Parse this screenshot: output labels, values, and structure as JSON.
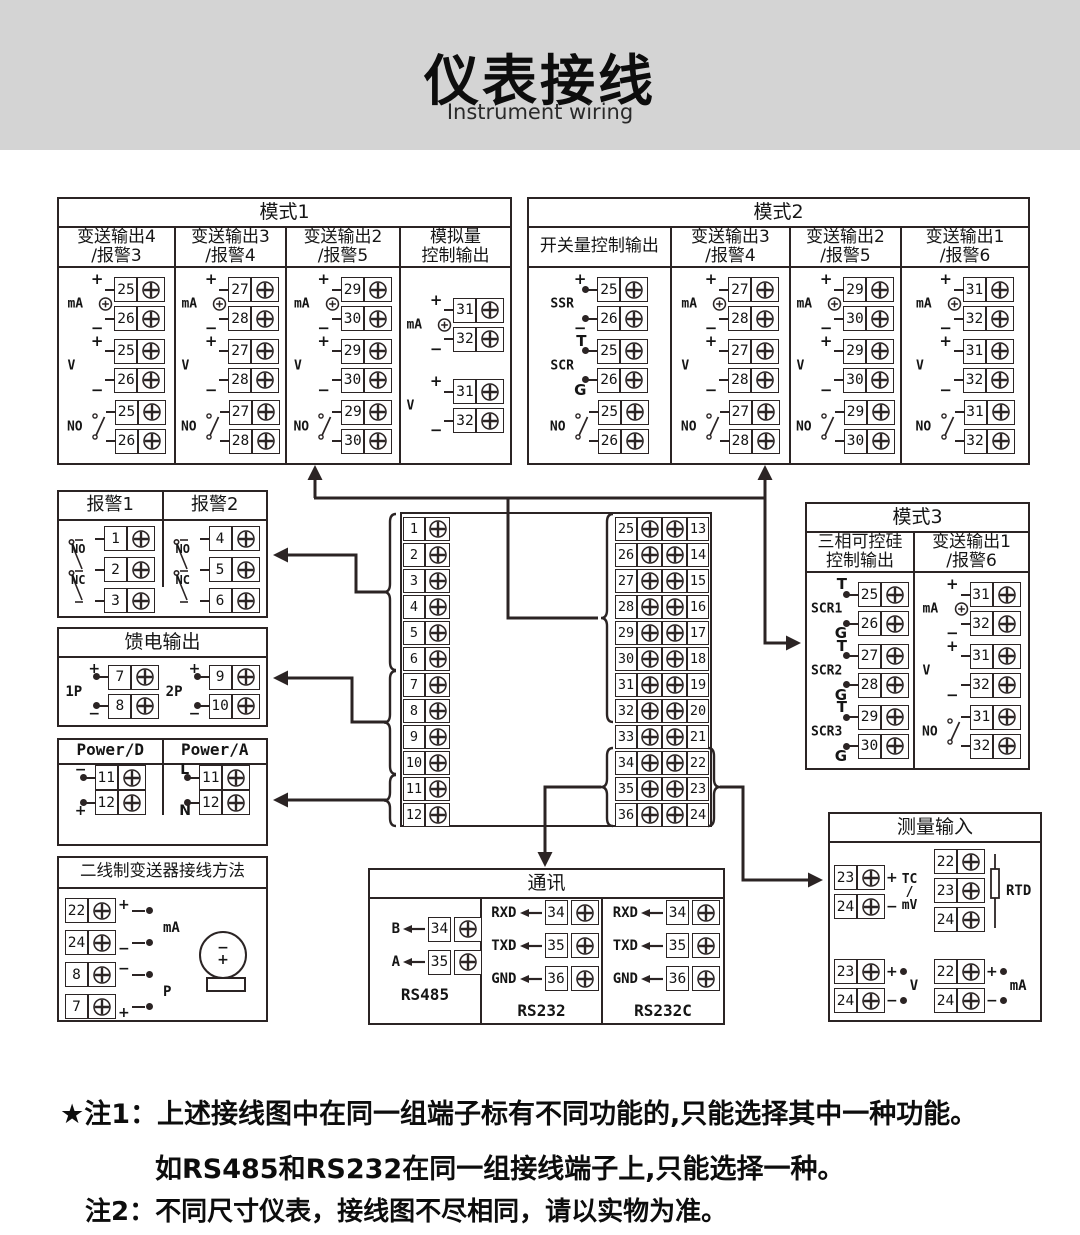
{
  "page": {
    "title": "仪表接线",
    "subtitle": "Instrument wiring"
  },
  "colors": {
    "line": "#2b2424",
    "band": "#d4d4d4",
    "paper": "#ffffff"
  },
  "notes": [
    {
      "prefix": "★注1：",
      "text": "上述接线图中在同一组端子标有不同功能的,只能选择其中一种功能。"
    },
    {
      "prefix": "",
      "text": "如RS485和RS232在同一组接线端子上,只能选择一种。"
    },
    {
      "prefix": "注2：",
      "text": "不同尺寸仪表，接线图不尽相同，请以实物为准。"
    }
  ],
  "mode1": {
    "title": "模式1",
    "columns": [
      {
        "label": "变送输出4\n/报警3",
        "groups": [
          {
            "kind": "source",
            "label": "mA",
            "signs": [
              "+",
              "−"
            ],
            "terminals": [
              "25",
              "26"
            ]
          },
          {
            "kind": "volt",
            "label": "V",
            "signs": [
              "+",
              "−"
            ],
            "terminals": [
              "25",
              "26"
            ]
          },
          {
            "kind": "relay",
            "label": "NO",
            "terminals": [
              "25",
              "26"
            ]
          }
        ]
      },
      {
        "label": "变送输出3\n/报警4",
        "groups": [
          {
            "kind": "source",
            "label": "mA",
            "signs": [
              "+",
              "−"
            ],
            "terminals": [
              "27",
              "28"
            ]
          },
          {
            "kind": "volt",
            "label": "V",
            "signs": [
              "+",
              "−"
            ],
            "terminals": [
              "27",
              "28"
            ]
          },
          {
            "kind": "relay",
            "label": "NO",
            "terminals": [
              "27",
              "28"
            ]
          }
        ]
      },
      {
        "label": "变送输出2\n/报警5",
        "groups": [
          {
            "kind": "source",
            "label": "mA",
            "signs": [
              "+",
              "−"
            ],
            "terminals": [
              "29",
              "30"
            ]
          },
          {
            "kind": "volt",
            "label": "V",
            "signs": [
              "+",
              "−"
            ],
            "terminals": [
              "29",
              "30"
            ]
          },
          {
            "kind": "relay",
            "label": "NO",
            "terminals": [
              "29",
              "30"
            ]
          }
        ]
      },
      {
        "label": "模拟量\n控制输出",
        "groups": [
          {
            "kind": "source",
            "label": "mA",
            "signs": [
              "+",
              "−"
            ],
            "terminals": [
              "31",
              "32"
            ]
          },
          {
            "kind": "volt",
            "label": "V",
            "signs": [
              "+",
              "−"
            ],
            "terminals": [
              "31",
              "32"
            ]
          }
        ]
      }
    ]
  },
  "mode2": {
    "title": "模式2",
    "columns": [
      {
        "label": "开关量控制输出",
        "groups": [
          {
            "kind": "ssr",
            "label": "SSR",
            "signs": [
              "+",
              "−"
            ],
            "terminals": [
              "25",
              "26"
            ]
          },
          {
            "kind": "scr",
            "label": "SCR",
            "signs": [
              "T",
              "G"
            ],
            "terminals": [
              "25",
              "26"
            ]
          },
          {
            "kind": "relay",
            "label": "NO",
            "terminals": [
              "25",
              "26"
            ]
          }
        ]
      },
      {
        "label": "变送输出3\n/报警4",
        "groups": [
          {
            "kind": "source",
            "label": "mA",
            "signs": [
              "+",
              "−"
            ],
            "terminals": [
              "27",
              "28"
            ]
          },
          {
            "kind": "volt",
            "label": "V",
            "signs": [
              "+",
              "−"
            ],
            "terminals": [
              "27",
              "28"
            ]
          },
          {
            "kind": "relay",
            "label": "NO",
            "terminals": [
              "27",
              "28"
            ]
          }
        ]
      },
      {
        "label": "变送输出2\n/报警5",
        "groups": [
          {
            "kind": "source",
            "label": "mA",
            "signs": [
              "+",
              "−"
            ],
            "terminals": [
              "29",
              "30"
            ]
          },
          {
            "kind": "volt",
            "label": "V",
            "signs": [
              "+",
              "−"
            ],
            "terminals": [
              "29",
              "30"
            ]
          },
          {
            "kind": "relay",
            "label": "NO",
            "terminals": [
              "29",
              "30"
            ]
          }
        ]
      },
      {
        "label": "变送输出1\n/报警6",
        "groups": [
          {
            "kind": "source",
            "label": "mA",
            "signs": [
              "+",
              "−"
            ],
            "terminals": [
              "31",
              "32"
            ]
          },
          {
            "kind": "volt",
            "label": "V",
            "signs": [
              "+",
              "−"
            ],
            "terminals": [
              "31",
              "32"
            ]
          },
          {
            "kind": "relay",
            "label": "NO",
            "terminals": [
              "31",
              "32"
            ]
          }
        ]
      }
    ]
  },
  "mode3": {
    "title": "模式3",
    "columns": [
      {
        "label": "三相可控硅\n控制输出",
        "groups": [
          {
            "kind": "scr",
            "label": "SCR1",
            "signs": [
              "T",
              "G"
            ],
            "terminals": [
              "25",
              "26"
            ]
          },
          {
            "kind": "scr",
            "label": "SCR2",
            "signs": [
              "T",
              "G"
            ],
            "terminals": [
              "27",
              "28"
            ]
          },
          {
            "kind": "scr",
            "label": "SCR3",
            "signs": [
              "T",
              "G"
            ],
            "terminals": [
              "29",
              "30"
            ]
          }
        ]
      },
      {
        "label": "变送输出1\n/报警6",
        "groups": [
          {
            "kind": "source",
            "label": "mA",
            "signs": [
              "+",
              "−"
            ],
            "terminals": [
              "31",
              "32"
            ]
          },
          {
            "kind": "volt",
            "label": "V",
            "signs": [
              "+",
              "−"
            ],
            "terminals": [
              "31",
              "32"
            ]
          },
          {
            "kind": "relay",
            "label": "NO",
            "terminals": [
              "31",
              "32"
            ]
          }
        ]
      }
    ]
  },
  "alarm": {
    "columns": [
      {
        "title": "报警1",
        "contacts": [
          "NO",
          "NC"
        ],
        "terminals": [
          "1",
          "2",
          "3"
        ]
      },
      {
        "title": "报警2",
        "contacts": [
          "NO",
          "NC"
        ],
        "terminals": [
          "4",
          "5",
          "6"
        ]
      }
    ]
  },
  "feed": {
    "title": "馈电输出",
    "groups": [
      {
        "label": "1P",
        "pins": [
          {
            "sign": "+",
            "num": "7"
          },
          {
            "sign": "−",
            "num": "8"
          }
        ]
      },
      {
        "label": "2P",
        "pins": [
          {
            "sign": "+",
            "num": "9"
          },
          {
            "sign": "−",
            "num": "10"
          }
        ]
      }
    ]
  },
  "power": {
    "columns": [
      {
        "title": "Power/D",
        "pins": [
          {
            "sign": "−",
            "num": "11"
          },
          {
            "sign": "+",
            "num": "12"
          }
        ]
      },
      {
        "title": "Power/A",
        "pins": [
          {
            "sign": "L",
            "num": "11"
          },
          {
            "sign": "N",
            "num": "12"
          }
        ]
      }
    ]
  },
  "twowire": {
    "title": "二线制变送器接线方法",
    "pins": [
      {
        "num": "22",
        "sign": "+"
      },
      {
        "num": "24",
        "sign": "−"
      },
      {
        "num": "8",
        "sign": "−"
      },
      {
        "num": "7",
        "sign": "+"
      }
    ],
    "mid_labels": [
      "mA",
      "P"
    ],
    "device_signs": [
      "−",
      "+"
    ]
  },
  "center": {
    "left": [
      "1",
      "2",
      "3",
      "4",
      "5",
      "6",
      "7",
      "8",
      "9",
      "10",
      "11",
      "12"
    ],
    "rows": [
      {
        "l": "25",
        "r": "13"
      },
      {
        "l": "26",
        "r": "14"
      },
      {
        "l": "27",
        "r": "15"
      },
      {
        "l": "28",
        "r": "16"
      },
      {
        "l": "29",
        "r": "17"
      },
      {
        "l": "30",
        "r": "18"
      },
      {
        "l": "31",
        "r": "19"
      },
      {
        "l": "32",
        "r": "20"
      },
      {
        "l": "33",
        "r": "21"
      },
      {
        "l": "34",
        "r": "22"
      },
      {
        "l": "35",
        "r": "23"
      },
      {
        "l": "36",
        "r": "24"
      }
    ]
  },
  "comm": {
    "title": "通讯",
    "columns": [
      {
        "caption": "RS485",
        "pins": [
          {
            "signal": "B",
            "num": "34"
          },
          {
            "signal": "A",
            "num": "35"
          }
        ]
      },
      {
        "caption": "RS232",
        "pins": [
          {
            "signal": "RXD",
            "num": "34"
          },
          {
            "signal": "TXD",
            "num": "35"
          },
          {
            "signal": "GND",
            "num": "36"
          }
        ]
      },
      {
        "caption": "RS232C",
        "pins": [
          {
            "signal": "RXD",
            "num": "34"
          },
          {
            "signal": "TXD",
            "num": "35"
          },
          {
            "signal": "GND",
            "num": "36"
          }
        ]
      }
    ]
  },
  "measure": {
    "title": "测量输入",
    "clusters": [
      {
        "id": "tc",
        "label_lines": [
          "TC",
          "/",
          "mV"
        ],
        "pins": [
          {
            "num": "23",
            "sign": "+"
          },
          {
            "num": "24",
            "sign": "−"
          }
        ]
      },
      {
        "id": "rtd",
        "label_lines": [
          "RTD"
        ],
        "pins": [
          {
            "num": "22",
            "sign": ""
          },
          {
            "num": "23",
            "sign": ""
          },
          {
            "num": "24",
            "sign": ""
          }
        ]
      },
      {
        "id": "v",
        "label_lines": [
          "V"
        ],
        "pins": [
          {
            "num": "23",
            "sign": "+"
          },
          {
            "num": "24",
            "sign": "−"
          }
        ]
      },
      {
        "id": "ma",
        "label_lines": [
          "mA"
        ],
        "pins": [
          {
            "num": "22",
            "sign": "+"
          },
          {
            "num": "24",
            "sign": "−"
          }
        ]
      }
    ]
  }
}
